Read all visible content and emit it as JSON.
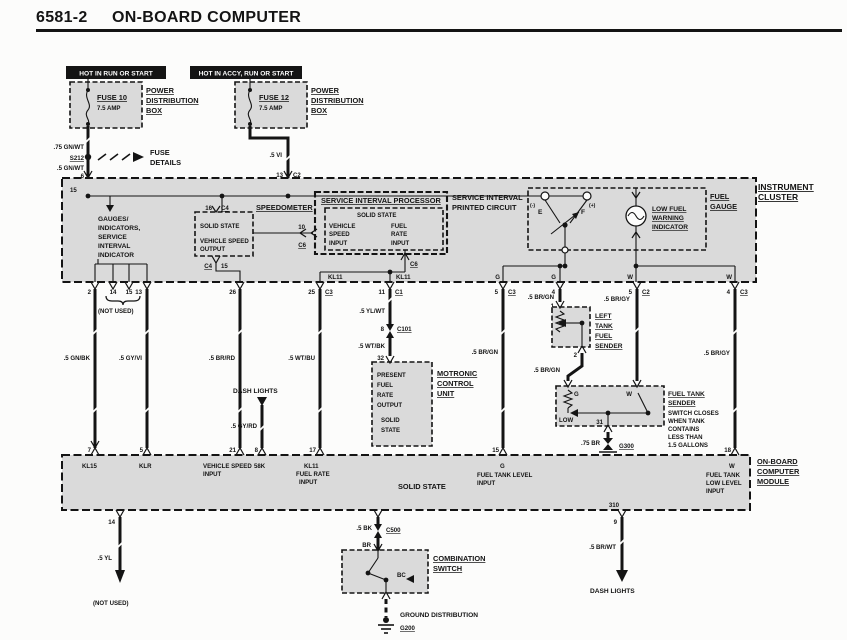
{
  "colors": {
    "ink": "#141414",
    "shade": "#dadada",
    "paper": "#fcfcfb"
  },
  "header": {
    "num": "6581-2",
    "title": "ON-BOARD COMPUTER"
  },
  "top": {
    "hot_run": "HOT IN RUN OR START",
    "hot_accy": "HOT IN ACCY, RUN OR START",
    "fuse10": "FUSE 10",
    "fuse10_amp": "7.5 AMP",
    "fuse12": "FUSE 12",
    "fuse12_amp": "7.5 AMP",
    "pdb": [
      "POWER",
      "DISTRIBUTION",
      "BOX"
    ],
    "w_75gnwt": ".75 GN/WT",
    "s212": "S212",
    "fuse_details": [
      "FUSE",
      "DETAILS"
    ],
    "w_5gnwt": ".5 GN/WT",
    "t6": "6",
    "w_5vi": ".5 VI",
    "t13": "13",
    "c2": "C2"
  },
  "cluster": {
    "label": [
      "INSTRUMENT",
      "CLUSTER"
    ],
    "t15": "15",
    "gauges": [
      "GAUGES/",
      "INDICATORS,",
      "SERVICE",
      "INTERVAL",
      "INDICATOR"
    ],
    "speedo": {
      "t16": "16",
      "c4t": "C4",
      "title": "SPEEDOMETER",
      "lines": [
        "SOLID STATE",
        "VEHICLE SPEED",
        "OUTPUT"
      ],
      "c4b": "C4",
      "t15": "15",
      "t10": "10",
      "c6": "C6"
    },
    "sip": {
      "title": "SERVICE INTERVAL PROCESSOR",
      "solid": "SOLID STATE",
      "in1": [
        "VEHICLE",
        "SPEED",
        "INPUT"
      ],
      "in2": [
        "FUEL",
        "RATE",
        "INPUT"
      ],
      "pc": [
        "SERVICE INTERVAL",
        "PRINTED CIRCUIT"
      ],
      "c6": "C6",
      "kl11a": "KL11",
      "kl11b": "KL11"
    },
    "gauge": {
      "label": [
        "FUEL",
        "GAUGE"
      ],
      "minus": "(-)",
      "plus": "(+)",
      "e": "E",
      "f": "F",
      "bulb": [
        "LOW FUEL",
        "WARNING",
        "INDICATOR"
      ]
    },
    "bt": {
      "t2": "2",
      "t14": "14",
      "t15": "15",
      "t13": "13",
      "not_used": "(NOT USED)",
      "t26": "26",
      "t25": "25",
      "c3a": "C3",
      "t11": "11",
      "c1": "C1",
      "gl": "G",
      "gr": "G",
      "wl": "W",
      "wr": "W",
      "t5a": "5",
      "c3b": "C3",
      "t4a": "4",
      "t5b": "5",
      "c2": "C2",
      "t4b": "4",
      "c3c": "C3"
    }
  },
  "wires": {
    "gnbk": ".5 GN/BK",
    "gyvi": ".5 GY/VI",
    "brrd": ".5 BR/RD",
    "wtbu": ".5 WT/BU",
    "gyrd": ".5 GY/RD",
    "dash_top": "DASH LIGHTS",
    "ylwt": ".5 YL/WT",
    "wtbk": ".5 WT/BK",
    "brgn_a": ".5 BR/GN",
    "brgn_b": ".5 BR/GN",
    "brgn_c": ".5 BR/GN",
    "brgy_a": ".5 BR/GY",
    "brgy_b": ".5 BR/GY",
    "br75": ".75 BR",
    "yl": ".5 YL",
    "bk": ".5 BK",
    "br": "BR",
    "brwt": ".5 BR/WT"
  },
  "motronic": {
    "t8": "8",
    "c101": "C101",
    "t32": "32",
    "box": [
      "PRESENT",
      "FUEL",
      "RATE",
      "OUTPUT",
      "SOLID",
      "STATE"
    ],
    "label": [
      "MOTRONIC",
      "CONTROL",
      "UNIT"
    ]
  },
  "left_sender": {
    "t1": "1",
    "t2": "2",
    "label": [
      "LEFT",
      "TANK",
      "FUEL",
      "SENDER"
    ]
  },
  "tank_sender": {
    "g": "G",
    "w": "W",
    "low": "LOW",
    "t31": "31",
    "label": [
      "FUEL TANK",
      "SENDER"
    ],
    "note": [
      "SWITCH CLOSES",
      "WHEN TANK",
      "CONTAINS",
      "LESS THAN",
      "1.5 GALLONS"
    ],
    "g300": "G300",
    "t18": "18"
  },
  "module": {
    "label": [
      "ON-BOARD",
      "COMPUTER",
      "MODULE"
    ],
    "t7": "7",
    "kl15": "KL15",
    "t5": "5",
    "klr": "KLR",
    "t21": "21",
    "vsi": [
      "VEHICLE SPEED",
      "INPUT"
    ],
    "t8": "8",
    "k58": "58K",
    "t17": "17",
    "fri": [
      "KL11",
      "FUEL RATE",
      "INPUT"
    ],
    "solid": "SOLID STATE",
    "t15": "15",
    "g": "G",
    "ftli": [
      "FUEL TANK LEVEL",
      "INPUT"
    ],
    "w": "W",
    "ftlli": [
      "FUEL TANK",
      "LOW LEVEL",
      "INPUT"
    ],
    "t310": "310",
    "t9": "9",
    "t14": "14"
  },
  "bottom": {
    "not_used": "(NOT USED)",
    "c500": "C500",
    "comb": [
      "COMBINATION",
      "SWITCH"
    ],
    "bc": "BC",
    "ground_dist": "GROUND DISTRIBUTION",
    "g200": "G200",
    "dash": "DASH LIGHTS"
  }
}
